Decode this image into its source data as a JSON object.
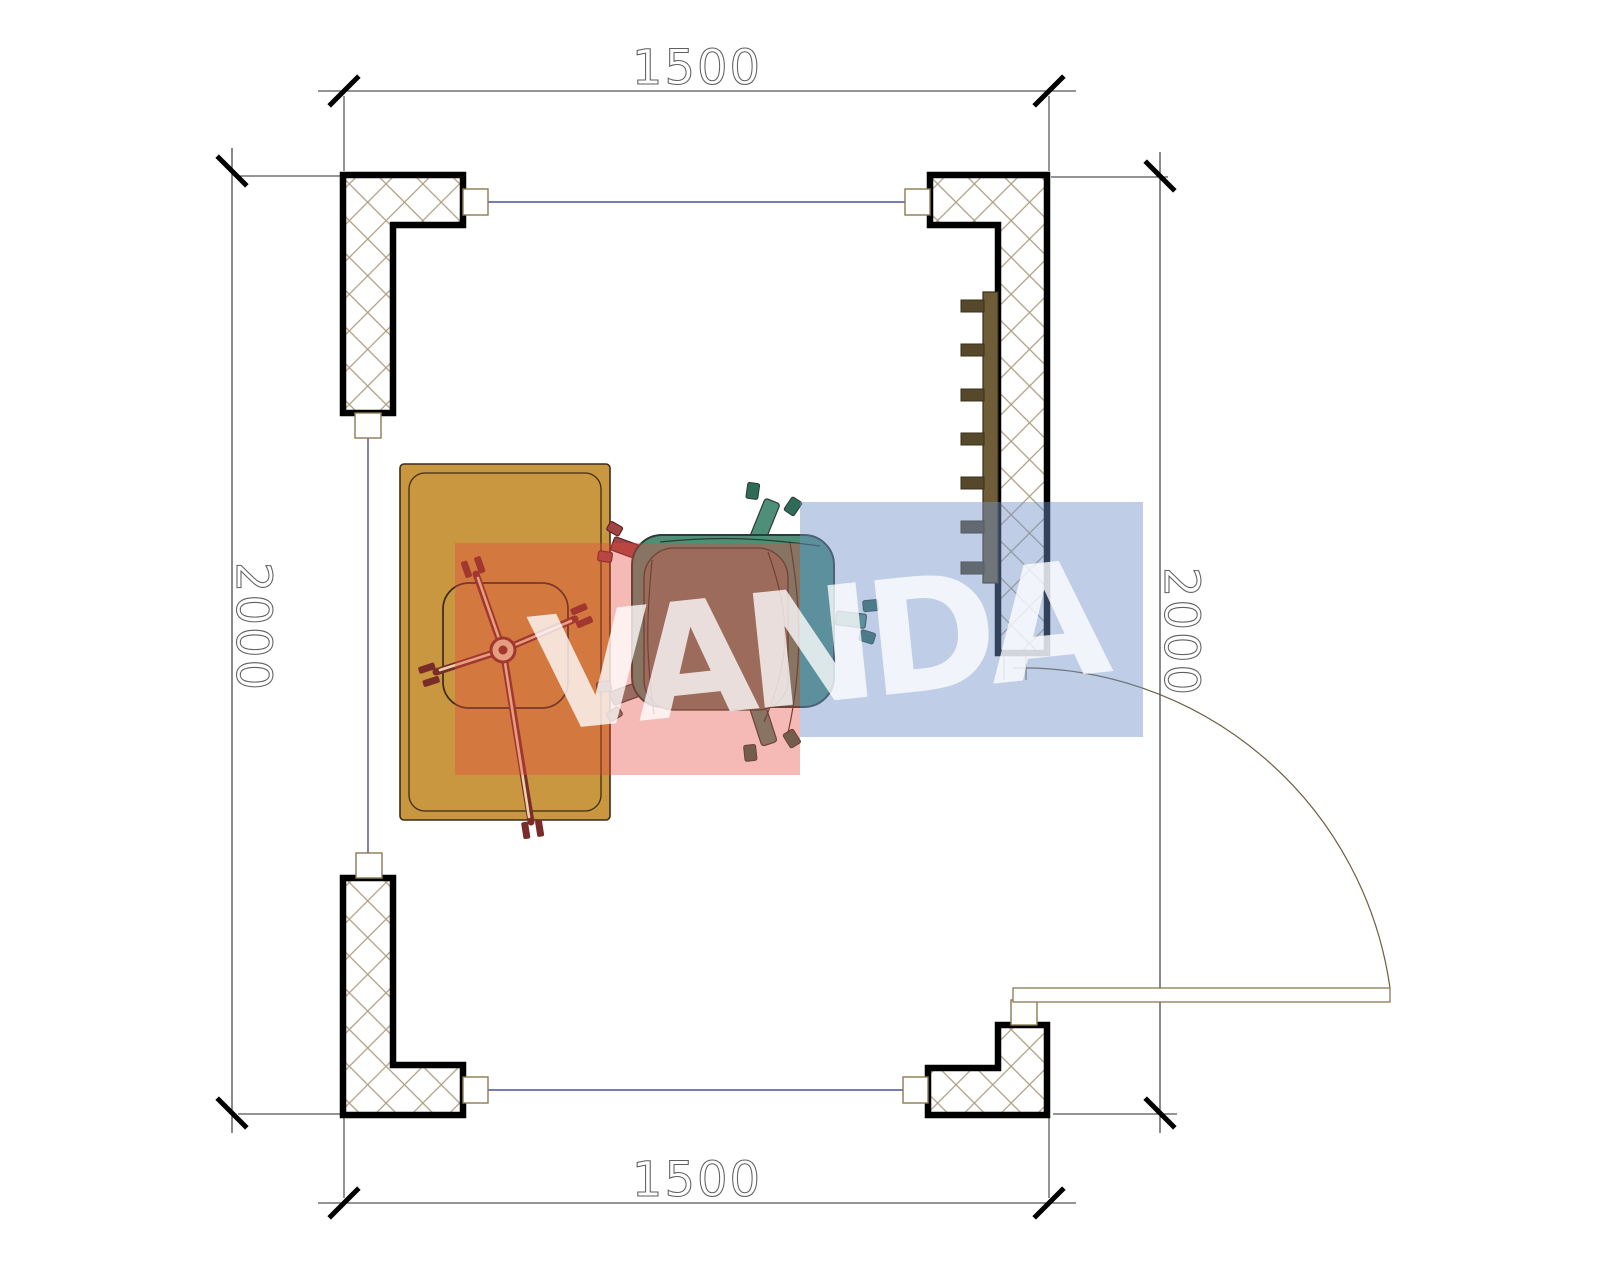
{
  "drawing": {
    "type_label": "floor-plan",
    "dimensions": {
      "top": "1500",
      "bottom": "1500",
      "left": "2000",
      "right": "2000"
    },
    "watermark": {
      "text": "VANDA"
    }
  },
  "colors": {
    "paper": "#ffffff",
    "wall-stroke": "#000000",
    "hatch-line": "#ab9c80",
    "axis-line": "#2b2e8c",
    "frame-line": "#8a7a52",
    "dim-line": "#2a2a2a",
    "dim-text": "#5f5f5f",
    "desk-fill": "#c8973f",
    "desk-line": "#3c2c18",
    "seat-line": "#3a2a1e",
    "chair-frame": "#7a2d28",
    "chair-fill": "#e6d4a8",
    "armchair-teal": "#4e8f7a",
    "armchair-cushion": "#70806c",
    "armchair-line": "#2c3b33",
    "armchair-prong": "#2e6b58",
    "leg-red": "#a04444",
    "radiator-fill": "#6f5d39",
    "radiator-dark": "#56482a",
    "wm-red": "rgba(229,73,63,0.38)",
    "wm-blue": "rgba(114,147,199,0.45)",
    "wm-text": "rgba(255,255,255,0.78)"
  }
}
